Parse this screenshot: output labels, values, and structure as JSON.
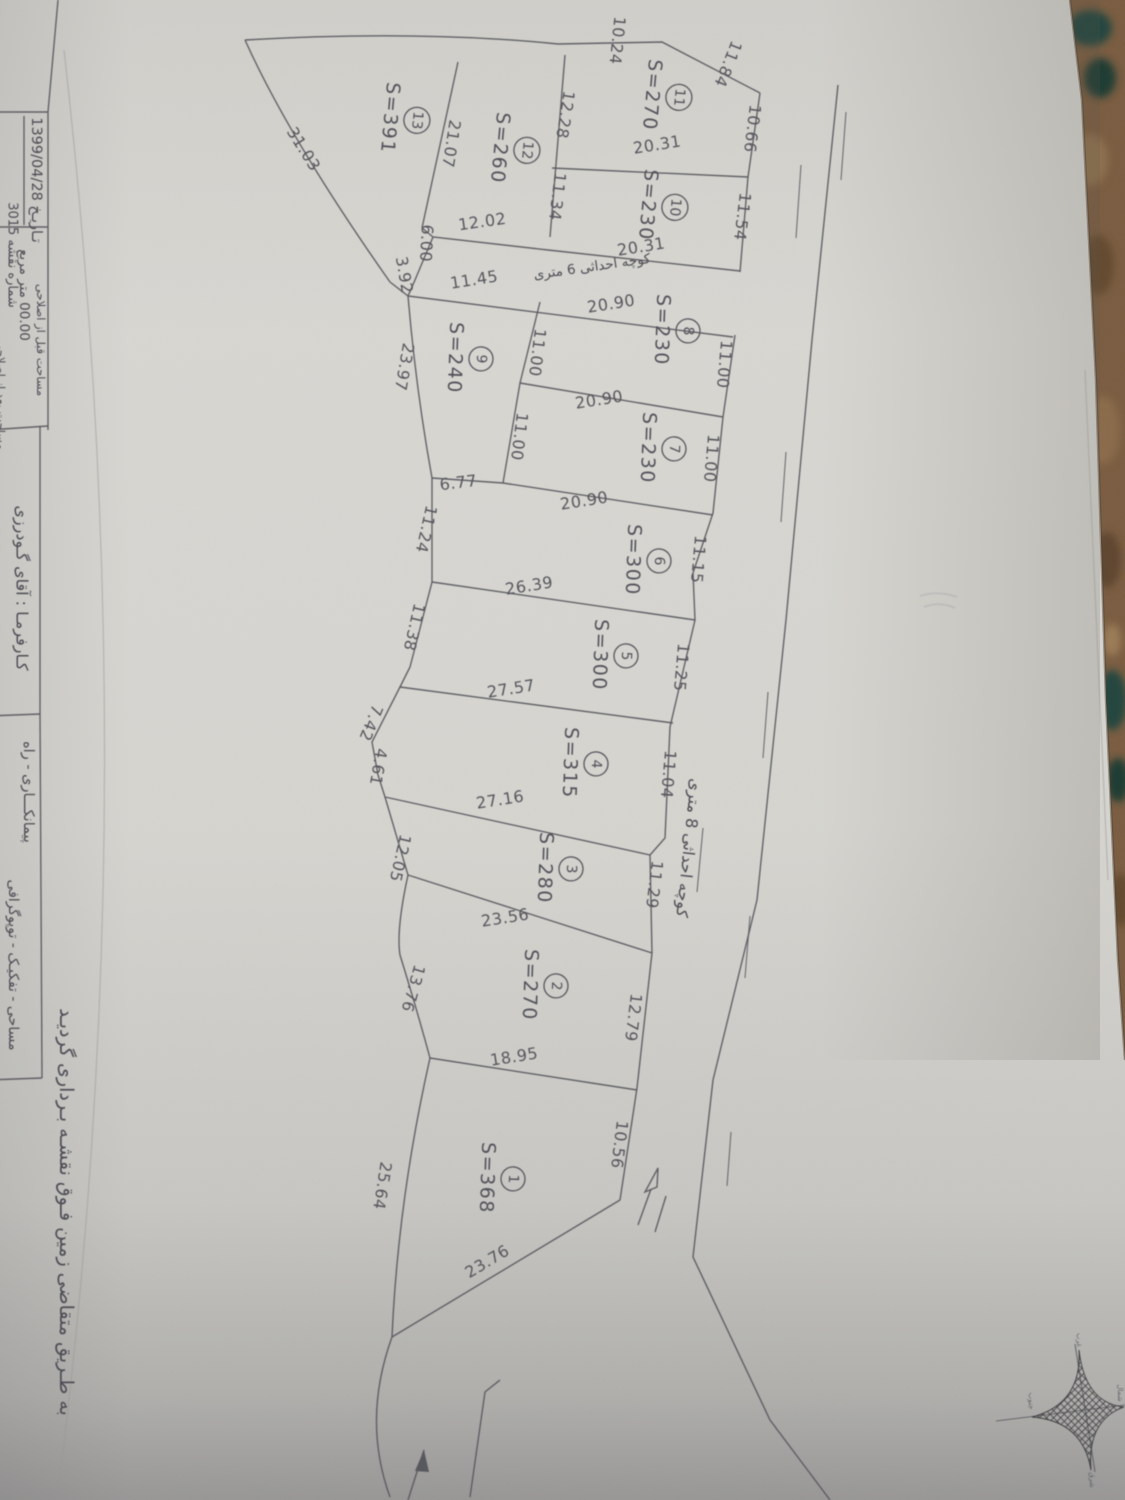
{
  "photo": {
    "paper_color": "#d6d5d0",
    "carpet_color": "#7a5c40",
    "carpet_teal": "#1e463e",
    "line_color": "#57575d",
    "text_color": "#4b4b52"
  },
  "title_block": {
    "date": "تـاریـخ 1399/04/28",
    "sheet_no": "شماره نقشه 3015",
    "area_before_value": "00.00 متر مربع",
    "area_before_label": "مساحت قبل از اصلاحی",
    "area_after_label": "مساحت بعد از اصلاحی",
    "client": "کـارفرمـا : آقای گـودرزی",
    "services_1": "پیمانکـــاری - راه",
    "services_2": "مساحی - تفکیـک - توپوگرافی",
    "certification": "به طـریق متقاضی زمین فـوق نقشـه بـرداری گردیـد"
  },
  "roads": {
    "alley_8m": "کوچه احداثی 8 متری",
    "alley_6m": "کوچه احداثی 6 متری"
  },
  "compass": {
    "north": "شمال",
    "south": "جنوب",
    "east": "شرق",
    "west": "غرب"
  },
  "plots": [
    {
      "no": "1",
      "area": "S=368"
    },
    {
      "no": "2",
      "area": "S=270"
    },
    {
      "no": "3",
      "area": "S=280"
    },
    {
      "no": "4",
      "area": "S=315"
    },
    {
      "no": "5",
      "area": "S=300"
    },
    {
      "no": "6",
      "area": "S=300"
    },
    {
      "no": "7",
      "area": "S=230"
    },
    {
      "no": "8",
      "area": "S=230"
    },
    {
      "no": "9",
      "area": "S=240"
    },
    {
      "no": "10",
      "area": "S=230"
    },
    {
      "no": "11",
      "area": "S=270"
    },
    {
      "no": "12",
      "area": "S=260"
    },
    {
      "no": "13",
      "area": "S=391"
    }
  ],
  "dims": [
    "31.03",
    "10.24",
    "11.84",
    "10.66",
    "11.54",
    "12.28",
    "21.07",
    "11.34",
    "20.31",
    "20.31",
    "12.02",
    "6.00",
    "3.92",
    "11.45",
    "20.90",
    "11.00",
    "11.00",
    "20.90",
    "11.00",
    "11.00",
    "20.90",
    "11.15",
    "6.77",
    "23.97",
    "11.24",
    "26.39",
    "11.38",
    "11.25",
    "27.57",
    "7.42",
    "4.61",
    "11.04",
    "27.16",
    "12.05",
    "11.29",
    "23.56",
    "13.76",
    "12.79",
    "18.95",
    "10.56",
    "25.64",
    "23.76"
  ]
}
